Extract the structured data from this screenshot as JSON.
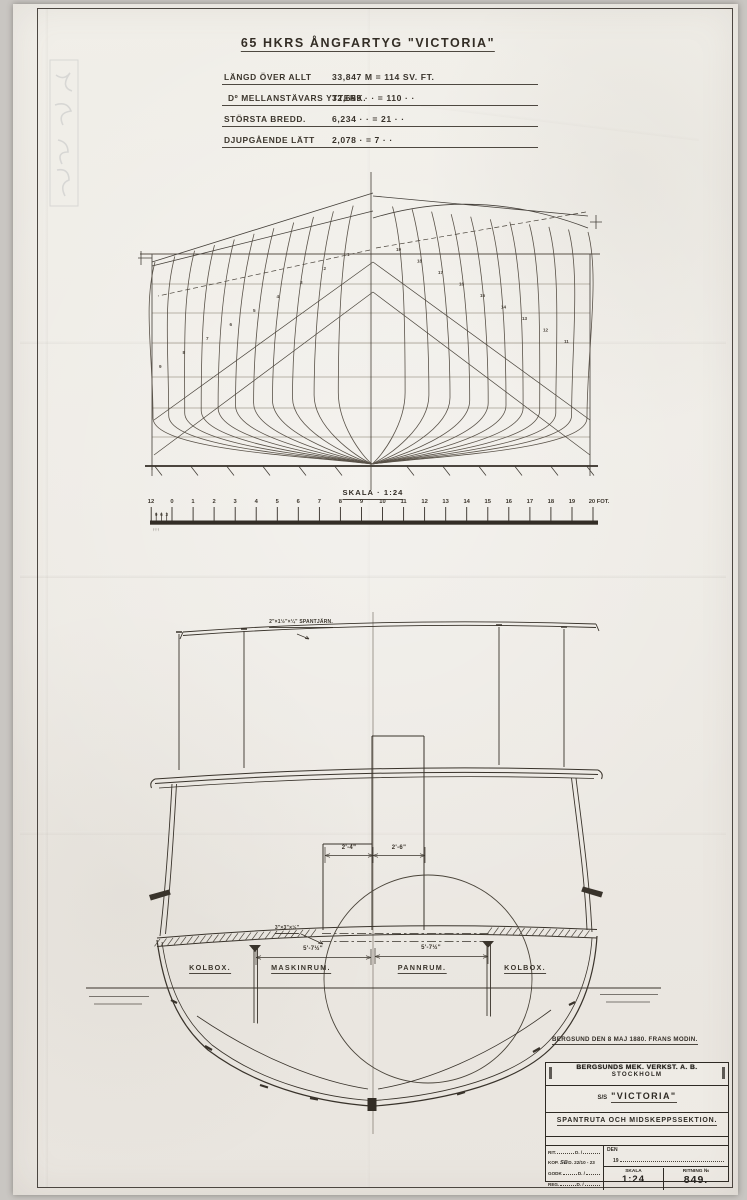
{
  "header": {
    "title": "65 HKRS ÅNGFARTYG \"VICTORIA\"",
    "specs": [
      {
        "label": "LÄNGD ÖVER ALLT",
        "value": "33,847 M = 114 SV. FT."
      },
      {
        "label": "Dº MELLANSTÄVARS YTTERK.",
        "value": "32,659 · · = 110 · ·"
      },
      {
        "label": "STÖRSTA BREDD.",
        "value": "6,234 · · = 21 · ·"
      },
      {
        "label": "DJUPGÅENDE LÄTT",
        "value": "2,078 · = 7 · ·"
      }
    ]
  },
  "body_plan": {
    "scale_label": "SKALA · 1:24",
    "stations_per_side": 11,
    "station_numbers_left": [
      "1",
      "2",
      "3",
      "4",
      "5",
      "6",
      "7",
      "8",
      "9"
    ],
    "station_numbers_right": [
      "19",
      "18",
      "17",
      "16",
      "15",
      "14",
      "13",
      "12",
      "11"
    ]
  },
  "ruler": {
    "major_labels": [
      "0",
      "1",
      "2",
      "3",
      "4",
      "5",
      "6",
      "7",
      "8",
      "9",
      "10",
      "11",
      "12",
      "13",
      "14",
      "15",
      "16",
      "17",
      "18",
      "19"
    ],
    "end_label": "20 FOT.",
    "inch_end_label": "12",
    "sub_labels": [
      "3",
      "6",
      "9"
    ]
  },
  "midship": {
    "frame_note": "2\"×1½\"×¼\" SPANTJÄRN.",
    "angle_note": "3\"×3\"×½\"",
    "dim_casing_left": "2'-4\"",
    "dim_casing_right": "2'-6\"",
    "dim_engine_room": "5'-7½\"",
    "dim_boiler_room": "5'-7½\"",
    "compartments": [
      "KOLBOX.",
      "MASKINRUM.",
      "PANNRUM.",
      "KOLBOX."
    ]
  },
  "signature": "BERGSUND DEN 8 MAJ 1880.  FRANS MODIN.",
  "title_block": {
    "company_line1": "BERGSUNDS MEK. VERKST. A. B.",
    "company_line2": "STOCKHOLM",
    "ship_prefix": "S/S",
    "ship_name": "\"VICTORIA\"",
    "subtitle": "SPANTRUTA OCH MIDSKEPPSSEKTION.",
    "fields": {
      "rows": [
        "RIT.",
        "KOP.",
        "GODK",
        "REG."
      ],
      "d_label": "D.   /",
      "kop_initials": "SB",
      "kop_value": "D. 22/10 - 23",
      "den_label": "DEN",
      "year_prefix": "19",
      "skala_label": "SKALA",
      "skala_value": "1:24",
      "ritning_label": "RITNING №",
      "ritning_value": "849."
    }
  },
  "colors": {
    "ink": "#3a342b",
    "pencil": "#a49d90",
    "paper": "#efece6"
  }
}
